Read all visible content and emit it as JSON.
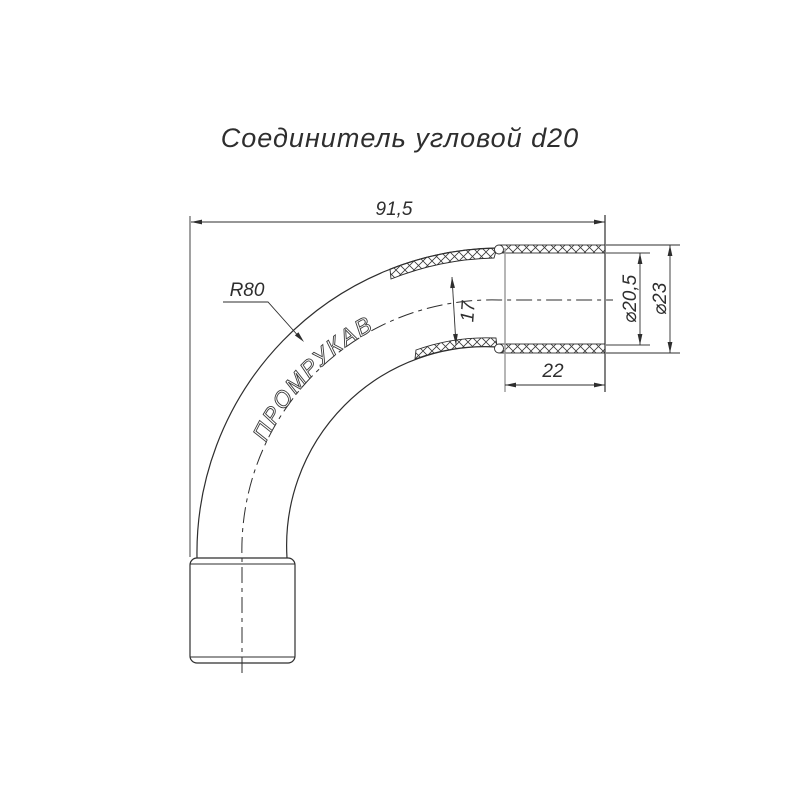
{
  "title": "Соединитель угловой d20",
  "brand_label": "ПРОМРУКАВ",
  "dimensions": {
    "overall_width": "91,5",
    "bend_radius": "R80",
    "tube_diameter": "17",
    "socket_length": "22",
    "inner_diameter": "⌀20,5",
    "outer_diameter": "⌀23"
  },
  "colors": {
    "line": "#2e2e2e",
    "gray_line": "#9e9e9e",
    "background": "#ffffff"
  }
}
